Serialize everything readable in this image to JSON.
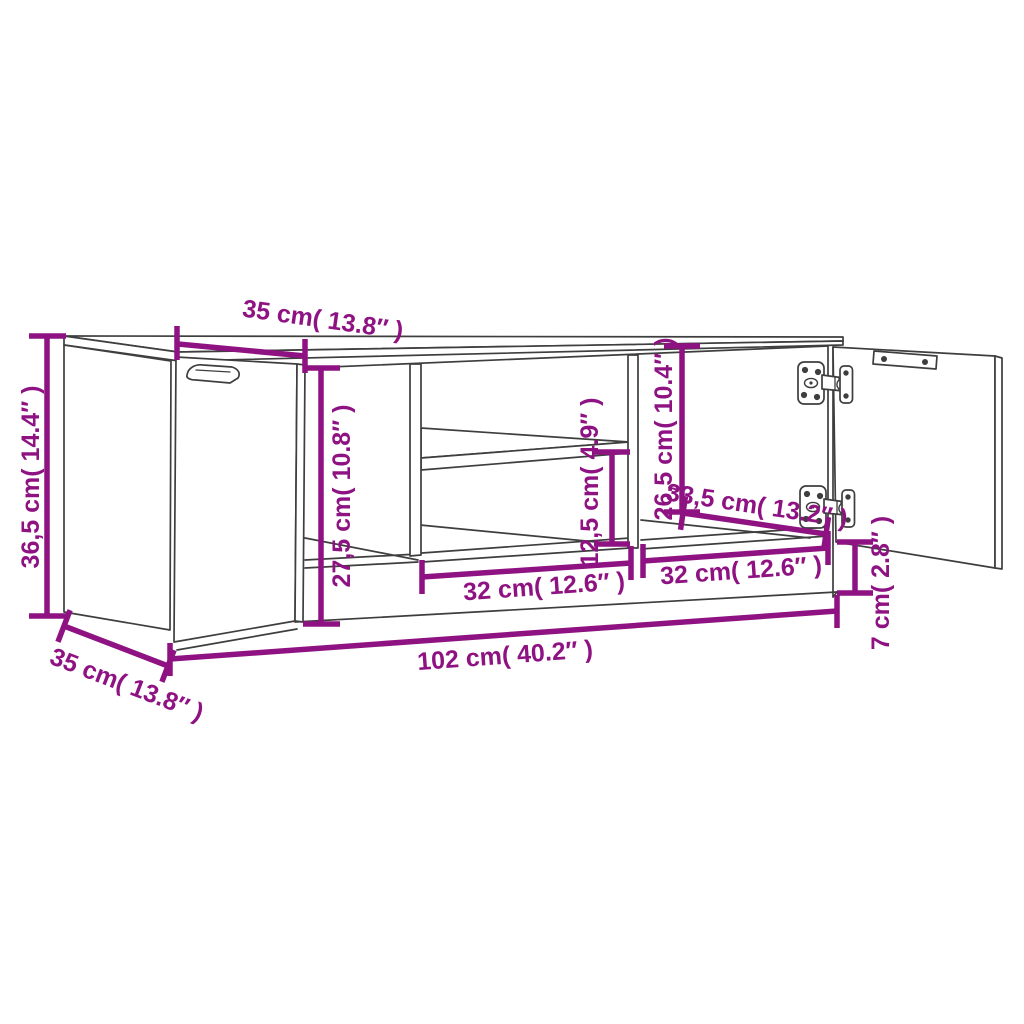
{
  "page": {
    "background": "#ffffff"
  },
  "diagram": {
    "type": "furniture-dimension-diagram",
    "subject": "TV cabinet line drawing with two open doors, middle shelf compartment and dimension annotations",
    "colors": {
      "dimension": "#8f1282",
      "outline": "#3e3e3e"
    },
    "labels": {
      "overall_height": "36,5 cm( 14.4″ )",
      "door_width_top": "35 cm( 13.8″ )",
      "left_opening_height": "27,5 cm( 10.8″ )",
      "shelf_space_height": "12,5 cm( 4.9″ )",
      "right_opening_height": "26,5 cm( 10.4″ )",
      "right_door_width": "33,5 cm( 13.2″ )",
      "middle_opening_width": "32 cm( 12.6″ )",
      "right_opening_width": "32 cm( 12.6″ )",
      "base_height": "7 cm( 2.8″ )",
      "overall_width": "102 cm( 40.2″ )",
      "depth": "35 cm( 13.8″ )"
    }
  }
}
